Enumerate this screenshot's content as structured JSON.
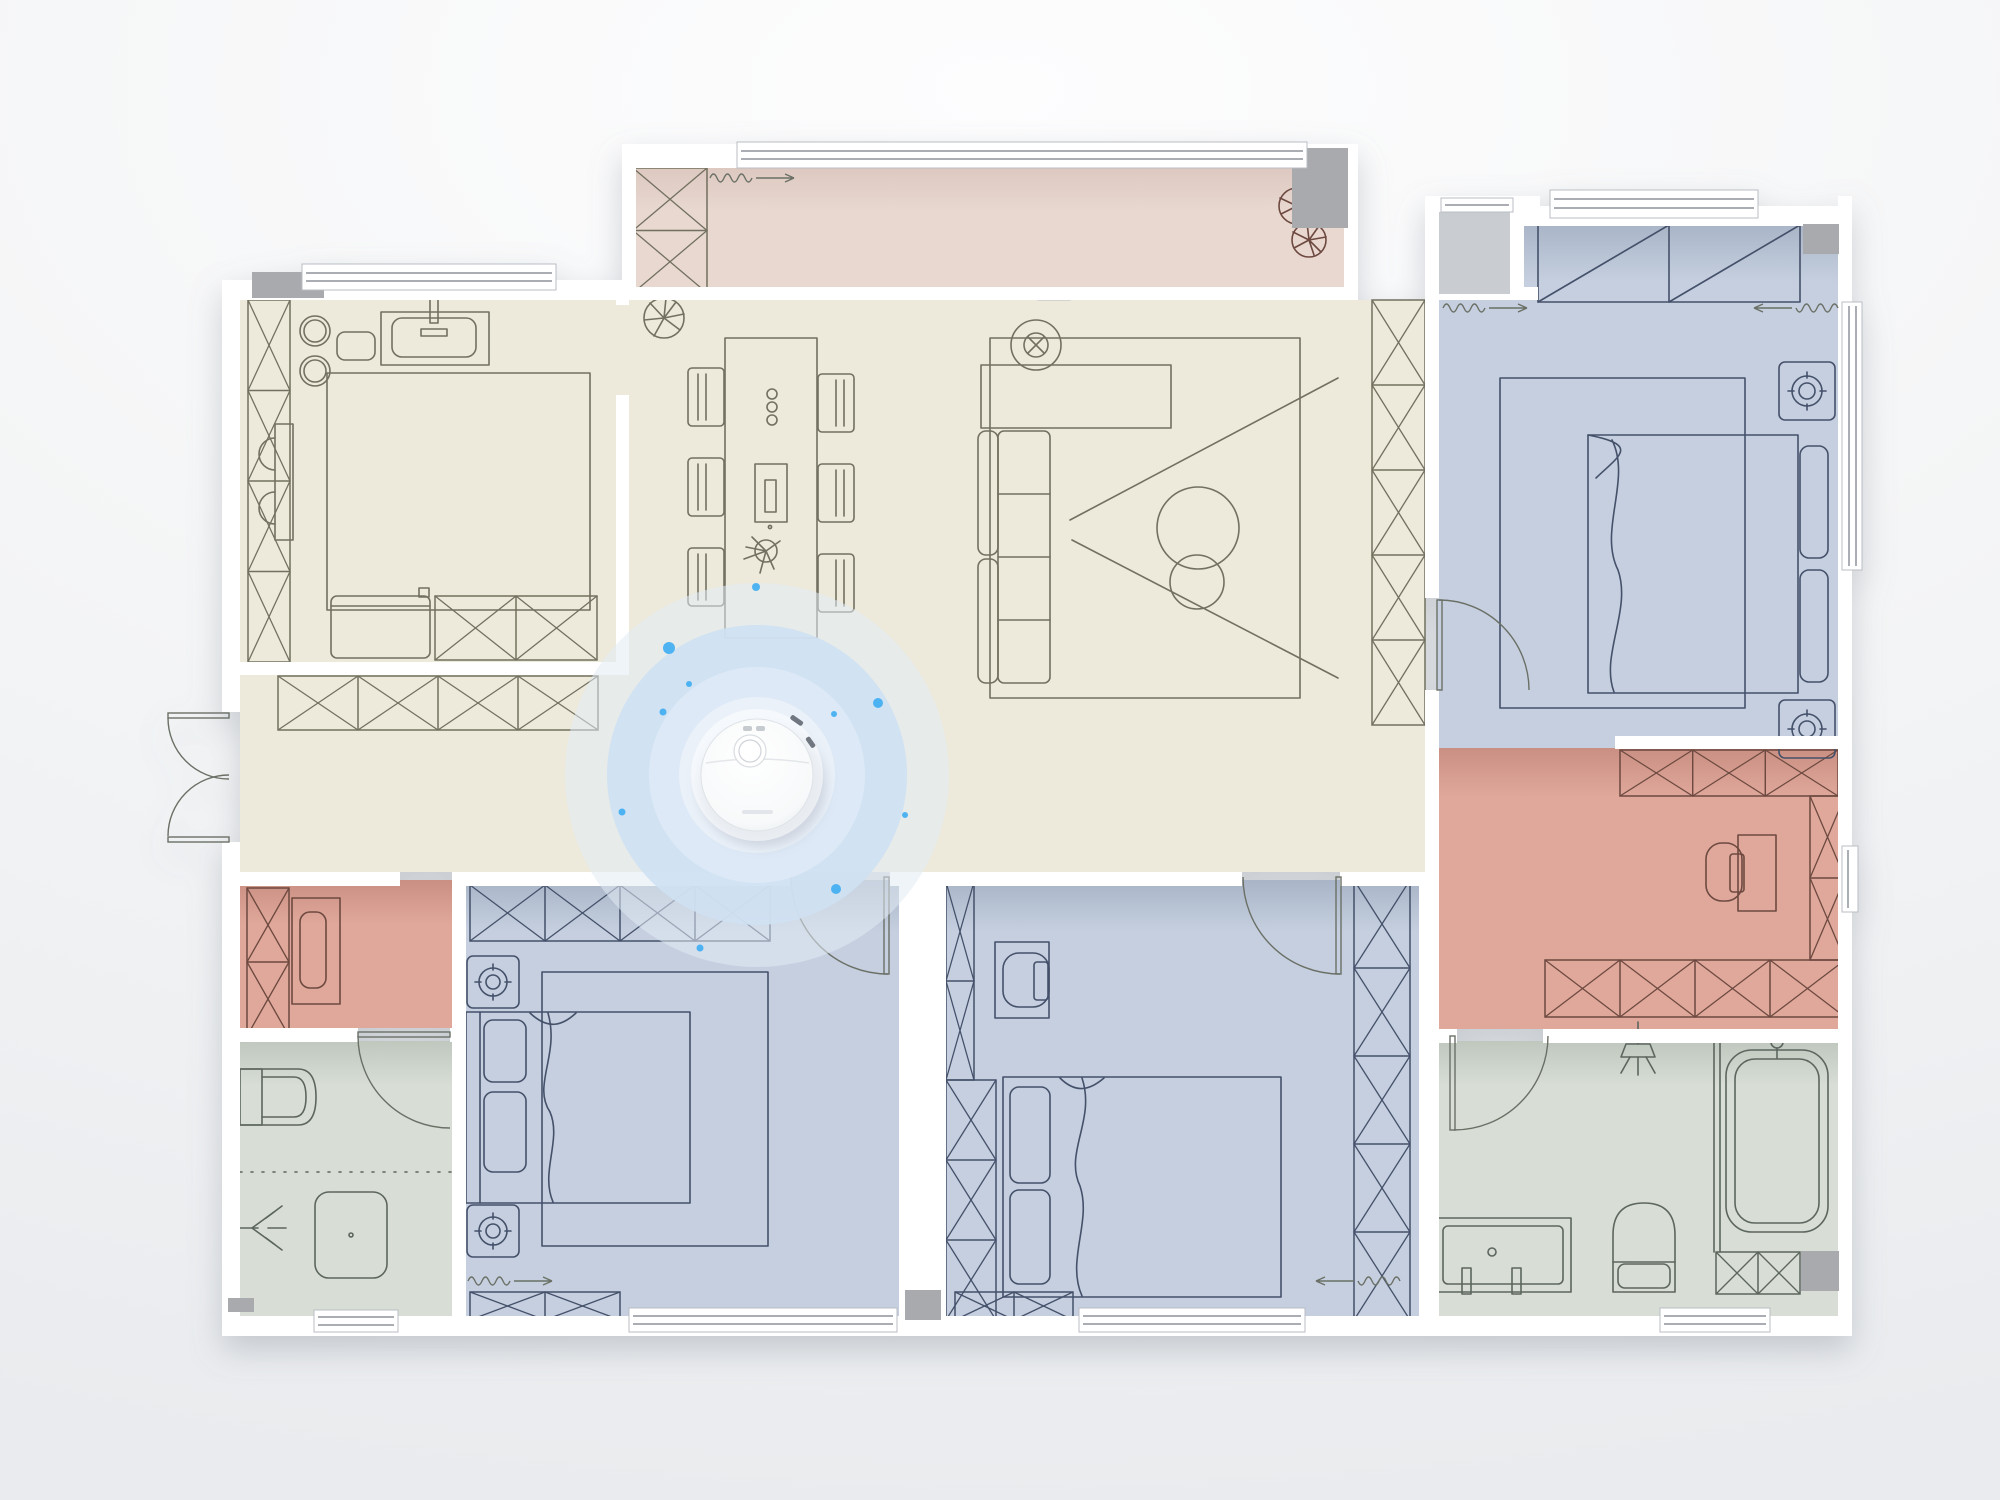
{
  "scene": {
    "background_top": "#fdfdfe",
    "background_bottom": "#e9ebee",
    "plan_shadow": "rgba(125,132,144,0.38)"
  },
  "palette": {
    "wall": "#ffffff",
    "structure_gray": "#a8aaae",
    "hall_gray": "#c9cdd2",
    "window_frame": "#b9bec3",
    "window_line": "#8d949b",
    "line_cream": "#72705f",
    "line_blue": "#44516a",
    "line_pink": "#6d4a41",
    "line_green": "#5c655e",
    "door_line": "#6b7066"
  },
  "rooms": {
    "study": {
      "name": "study-bedroom-top-left",
      "fill": "#edeadc"
    },
    "living": {
      "name": "living-dining-hall",
      "fill": "#edeadc"
    },
    "balcony": {
      "name": "balcony-top",
      "fill": "#e8d8d0"
    },
    "bedroom_tr": {
      "name": "bedroom-top-right",
      "fill": "#c5cfdf"
    },
    "dressing": {
      "name": "walk-in-closet-right",
      "fill": "#e0a89b"
    },
    "entry_closet": {
      "name": "closet-left",
      "fill": "#e0a89b"
    },
    "bathroom_l": {
      "name": "bathroom-bottom-left",
      "fill": "#d8ded5"
    },
    "bathroom_r": {
      "name": "bathroom-bottom-right",
      "fill": "#d8ded5"
    },
    "bedroom_a": {
      "name": "bedroom-bottom-left",
      "fill": "#c5cfdf"
    },
    "bedroom_b": {
      "name": "bedroom-bottom-middle",
      "fill": "#c5cfdf"
    },
    "ac_platform": {
      "name": "utility-notch-top-right",
      "fill": "#c9cdd2"
    }
  },
  "robot": {
    "center": [
      757,
      775
    ],
    "body_fill": "#fdfdfd",
    "body_edge": "#dfe3e7",
    "turret_fill": "#ffffff",
    "accent": "#3fadf2",
    "ripple_rings": [
      {
        "r": 192,
        "fill": "#e2ebf4",
        "opacity": 0.55
      },
      {
        "r": 150,
        "fill": "#cfe1f2",
        "opacity": 0.92
      },
      {
        "r": 108,
        "fill": "#dde9f6",
        "opacity": 1
      },
      {
        "r": 78,
        "fill": "#eaf1f9",
        "opacity": 1
      }
    ],
    "dots": [
      [
        669,
        648,
        6
      ],
      [
        878,
        703,
        5
      ],
      [
        836,
        889,
        5
      ],
      [
        663,
        712,
        3.5
      ],
      [
        689,
        684,
        3
      ],
      [
        756,
        587,
        4
      ],
      [
        622,
        812,
        3.5
      ],
      [
        834,
        714,
        3
      ],
      [
        700,
        948,
        3.5
      ],
      [
        905,
        815,
        3
      ]
    ]
  }
}
